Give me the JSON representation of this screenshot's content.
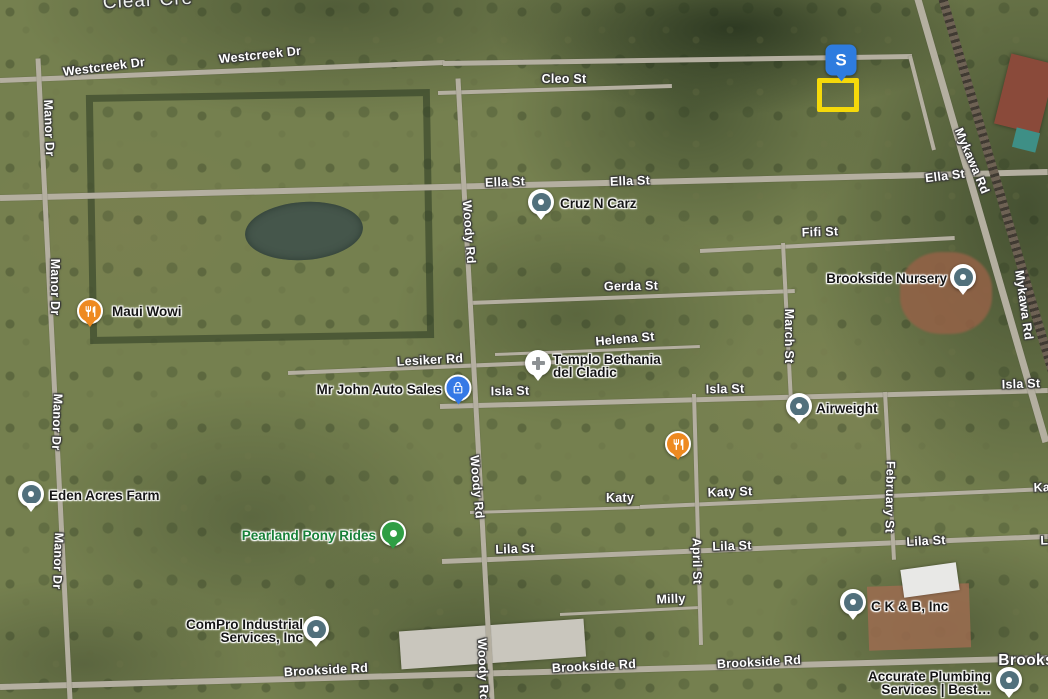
{
  "map_type": "satellite",
  "colors": {
    "generic_pin": "#51707c",
    "restaurant_pin": "#ee8a21",
    "auto_pin": "#3579e6",
    "attraction_pin": "#2f9e44",
    "attraction_label": "#188038",
    "s_marker": "#2e7cdf",
    "selection_rect": "#f5d90a",
    "street_label": "#ffffff",
    "poi_label": "#151515"
  },
  "selection": {
    "marker_text": "S",
    "marker_x": 841,
    "marker_y": 60,
    "rect_x": 817,
    "rect_y": 78,
    "rect_w": 32,
    "rect_h": 24
  },
  "street_labels": [
    {
      "text": "Clear Cre",
      "x": 148,
      "y": 1,
      "angle": -3,
      "kind": "water"
    },
    {
      "text": "Westcreek Dr",
      "x": 104,
      "y": 67,
      "angle": -7
    },
    {
      "text": "Westcreek Dr",
      "x": 260,
      "y": 55,
      "angle": -6
    },
    {
      "text": "Cleo St",
      "x": 564,
      "y": 79,
      "angle": 0
    },
    {
      "text": "Ella St",
      "x": 505,
      "y": 182,
      "angle": -2
    },
    {
      "text": "Ella St",
      "x": 630,
      "y": 181,
      "angle": -2
    },
    {
      "text": "Ella St",
      "x": 945,
      "y": 176,
      "angle": -7
    },
    {
      "text": "Mykawa Rd",
      "x": 972,
      "y": 161,
      "angle": 67
    },
    {
      "text": "Mykawa Rd",
      "x": 1024,
      "y": 305,
      "angle": 82
    },
    {
      "text": "Manor Dr",
      "x": 49,
      "y": 128,
      "angle": 88
    },
    {
      "text": "Manor Dr",
      "x": 55,
      "y": 287,
      "angle": 90
    },
    {
      "text": "Manor Dr",
      "x": 57,
      "y": 422,
      "angle": 92
    },
    {
      "text": "Manor Dr",
      "x": 58,
      "y": 561,
      "angle": 92
    },
    {
      "text": "Fifi St",
      "x": 820,
      "y": 232,
      "angle": -2
    },
    {
      "text": "Gerda St",
      "x": 631,
      "y": 286,
      "angle": -1
    },
    {
      "text": "Helena St",
      "x": 625,
      "y": 339,
      "angle": -5
    },
    {
      "text": "Lesiker Rd",
      "x": 430,
      "y": 360,
      "angle": -3
    },
    {
      "text": "Isla St",
      "x": 510,
      "y": 391,
      "angle": -1
    },
    {
      "text": "Isla St",
      "x": 725,
      "y": 389,
      "angle": -1
    },
    {
      "text": "Isla St",
      "x": 1021,
      "y": 384,
      "angle": -2
    },
    {
      "text": "Woody Rd",
      "x": 469,
      "y": 232,
      "angle": 86
    },
    {
      "text": "Woody Rd",
      "x": 477,
      "y": 487,
      "angle": 85
    },
    {
      "text": "Woody Rd",
      "x": 483,
      "y": 670,
      "angle": 88
    },
    {
      "text": "March St",
      "x": 789,
      "y": 336,
      "angle": 90
    },
    {
      "text": "February St",
      "x": 890,
      "y": 497,
      "angle": 91
    },
    {
      "text": "April St",
      "x": 697,
      "y": 561,
      "angle": 89
    },
    {
      "text": "Katy",
      "x": 620,
      "y": 498,
      "angle": 0
    },
    {
      "text": "Katy St",
      "x": 730,
      "y": 492,
      "angle": -2
    },
    {
      "text": "Katy St",
      "x": 1056,
      "y": 487,
      "angle": -2
    },
    {
      "text": "Lila St",
      "x": 515,
      "y": 549,
      "angle": -2
    },
    {
      "text": "Lila St",
      "x": 732,
      "y": 546,
      "angle": -2
    },
    {
      "text": "Lila St",
      "x": 926,
      "y": 541,
      "angle": -3
    },
    {
      "text": "Lila St",
      "x": 1060,
      "y": 540,
      "angle": -2
    },
    {
      "text": "Milly",
      "x": 671,
      "y": 599,
      "angle": -2
    },
    {
      "text": "Brookside Rd",
      "x": 326,
      "y": 670,
      "angle": -3
    },
    {
      "text": "Brookside Rd",
      "x": 594,
      "y": 666,
      "angle": -3
    },
    {
      "text": "Brookside Rd",
      "x": 759,
      "y": 662,
      "angle": -3
    },
    {
      "text": "Brookside",
      "x": 1038,
      "y": 661,
      "angle": 0,
      "kind": "locality"
    }
  ],
  "pois": [
    {
      "lines": [
        "Maui Wowi"
      ],
      "anchor": "left",
      "ax": 112,
      "ay": 312,
      "pin": "restaurant",
      "icon": "fork-knife-icon",
      "px": 90,
      "py": 311
    },
    {
      "lines": [
        "Cruz N Carz"
      ],
      "anchor": "left",
      "ax": 560,
      "ay": 204,
      "pin": "generic",
      "icon": "place-dot-icon",
      "px": 541,
      "py": 202
    },
    {
      "lines": [
        "Brookside Nursery"
      ],
      "anchor": "right",
      "ax": 947,
      "ay": 279,
      "pin": "generic",
      "icon": "place-dot-icon",
      "px": 963,
      "py": 277
    },
    {
      "lines": [
        "Templo Bethania",
        "del Cladic"
      ],
      "anchor": "left",
      "ax": 553,
      "ay": 360,
      "pin": "church",
      "icon": "cross-icon",
      "px": 538,
      "py": 363
    },
    {
      "lines": [
        "Mr John Auto Sales"
      ],
      "anchor": "right",
      "ax": 442,
      "ay": 390,
      "pin": "auto",
      "icon": "padlock-icon",
      "px": 458,
      "py": 388
    },
    {
      "lines": [
        "Airweight"
      ],
      "anchor": "left",
      "ax": 816,
      "ay": 409,
      "pin": "generic",
      "icon": "place-dot-icon",
      "px": 799,
      "py": 406
    },
    {
      "lines": [],
      "anchor": "left",
      "ax": 0,
      "ay": 0,
      "pin": "restaurant",
      "icon": "fork-knife-icon",
      "px": 678,
      "py": 444
    },
    {
      "lines": [
        "Eden Acres Farm"
      ],
      "anchor": "left",
      "ax": 49,
      "ay": 496,
      "pin": "generic",
      "icon": "place-dot-icon",
      "px": 31,
      "py": 494
    },
    {
      "lines": [
        "Pearland Pony Rides"
      ],
      "anchor": "right",
      "ax": 376,
      "ay": 536,
      "pin": "attraction",
      "icon": "place-dot-icon",
      "px": 393,
      "py": 533,
      "color": "#188038"
    },
    {
      "lines": [
        "ComPro Industrial",
        "Services, Inc"
      ],
      "anchor": "right",
      "ax": 303,
      "ay": 625,
      "pin": "generic",
      "icon": "place-dot-icon",
      "px": 316,
      "py": 629
    },
    {
      "lines": [
        "C K & B, Inc"
      ],
      "anchor": "left",
      "ax": 871,
      "ay": 607,
      "pin": "generic",
      "icon": "place-dot-icon",
      "px": 853,
      "py": 602
    },
    {
      "lines": [
        "Accurate Plumbing",
        "Services | Best…"
      ],
      "anchor": "right",
      "ax": 991,
      "ay": 677,
      "pin": "generic",
      "icon": "place-dot-icon",
      "px": 1009,
      "py": 680
    }
  ],
  "roads": [
    {
      "name": "Westcreek Dr",
      "x1": 0,
      "y1": 80,
      "x2": 445,
      "y2": 62,
      "w": 5
    },
    {
      "name": "Westcreek Dr",
      "x1": 443,
      "y1": 63,
      "x2": 912,
      "y2": 56,
      "w": 5
    },
    {
      "name": "",
      "x1": 910,
      "y1": 56,
      "x2": 934,
      "y2": 150,
      "w": 4
    },
    {
      "name": "Cleo St",
      "x1": 438,
      "y1": 93,
      "x2": 672,
      "y2": 86,
      "w": 4
    },
    {
      "name": "Ella St",
      "x1": 0,
      "y1": 198,
      "x2": 1048,
      "y2": 172,
      "w": 6
    },
    {
      "name": "Fifi St",
      "x1": 700,
      "y1": 251,
      "x2": 955,
      "y2": 238,
      "w": 4
    },
    {
      "name": "Gerda St",
      "x1": 468,
      "y1": 303,
      "x2": 795,
      "y2": 291,
      "w": 4
    },
    {
      "name": "Helena St",
      "x1": 495,
      "y1": 354,
      "x2": 700,
      "y2": 346,
      "w": 3
    },
    {
      "name": "Lesiker Rd",
      "x1": 288,
      "y1": 373,
      "x2": 560,
      "y2": 362,
      "w": 4
    },
    {
      "name": "Isla St",
      "x1": 440,
      "y1": 406,
      "x2": 1048,
      "y2": 390,
      "w": 5
    },
    {
      "name": "Katy",
      "x1": 470,
      "y1": 512,
      "x2": 640,
      "y2": 507,
      "w": 3
    },
    {
      "name": "Katy St",
      "x1": 640,
      "y1": 507,
      "x2": 1048,
      "y2": 489,
      "w": 4
    },
    {
      "name": "Lila St",
      "x1": 442,
      "y1": 561,
      "x2": 1048,
      "y2": 536,
      "w": 5
    },
    {
      "name": "Milly",
      "x1": 560,
      "y1": 614,
      "x2": 700,
      "y2": 607,
      "w": 3
    },
    {
      "name": "Brookside Rd",
      "x1": 0,
      "y1": 687,
      "x2": 1048,
      "y2": 658,
      "w": 6
    },
    {
      "name": "Manor Dr",
      "x1": 38,
      "y1": 58,
      "x2": 70,
      "y2": 699,
      "w": 5
    },
    {
      "name": "Woody Rd",
      "x1": 458,
      "y1": 78,
      "x2": 492,
      "y2": 699,
      "w": 5
    },
    {
      "name": "April St",
      "x1": 694,
      "y1": 394,
      "x2": 701,
      "y2": 645,
      "w": 4
    },
    {
      "name": "March St",
      "x1": 783,
      "y1": 243,
      "x2": 791,
      "y2": 402,
      "w": 4
    },
    {
      "name": "February St",
      "x1": 885,
      "y1": 392,
      "x2": 894,
      "y2": 560,
      "w": 4
    },
    {
      "name": "Mykawa Rd",
      "x1": 916,
      "y1": -8,
      "x2": 1046,
      "y2": 442,
      "w": 7
    },
    {
      "name": "railroad",
      "x1": 941,
      "y1": -8,
      "x2": 1075,
      "y2": 448,
      "w": 9,
      "rail": true
    }
  ]
}
